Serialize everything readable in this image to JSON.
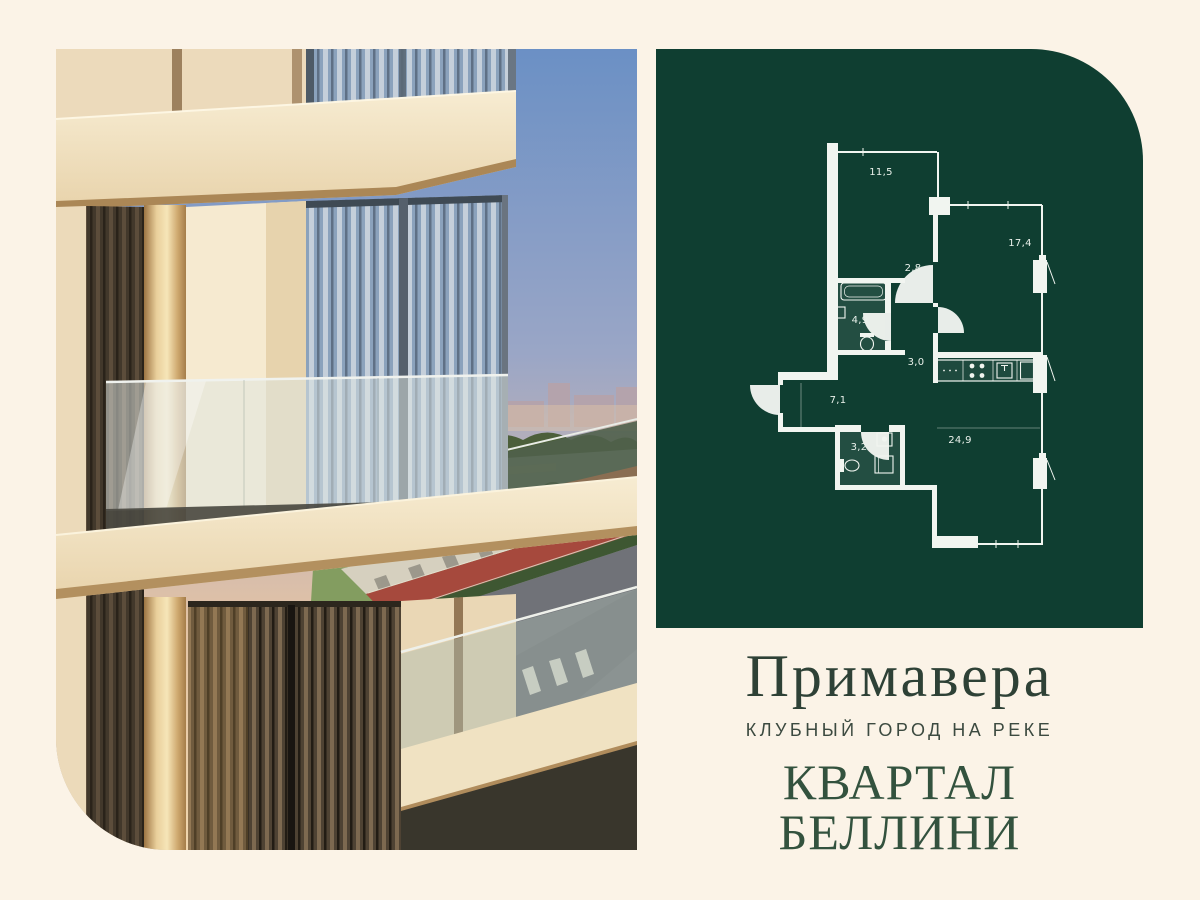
{
  "brand": {
    "project_name": "Примавера",
    "tagline": "КЛУБНЫЙ ГОРОД НА РЕКЕ",
    "quarter_name": "КВАРТАЛ БЕЛЛИНИ"
  },
  "floor_plan": {
    "rooms": [
      {
        "area": "11,5",
        "x": 225,
        "y": 126
      },
      {
        "area": "17,4",
        "x": 364,
        "y": 197
      },
      {
        "area": "2,8",
        "x": 257,
        "y": 222
      },
      {
        "area": "4,9",
        "x": 204,
        "y": 274
      },
      {
        "area": "3,0",
        "x": 260,
        "y": 316
      },
      {
        "area": "7,1",
        "x": 182,
        "y": 354
      },
      {
        "area": "3,2",
        "x": 203,
        "y": 401
      },
      {
        "area": "24,9",
        "x": 304,
        "y": 394
      }
    ]
  },
  "colors": {
    "background_cream": "#fbf3e7",
    "panel_green": "#0f3e31",
    "plan_line_white": "#f1f5f0",
    "project_title_green": "#2e4136",
    "quarter_title_green": "#33523e",
    "bike_lane_red": "#a6493d"
  }
}
